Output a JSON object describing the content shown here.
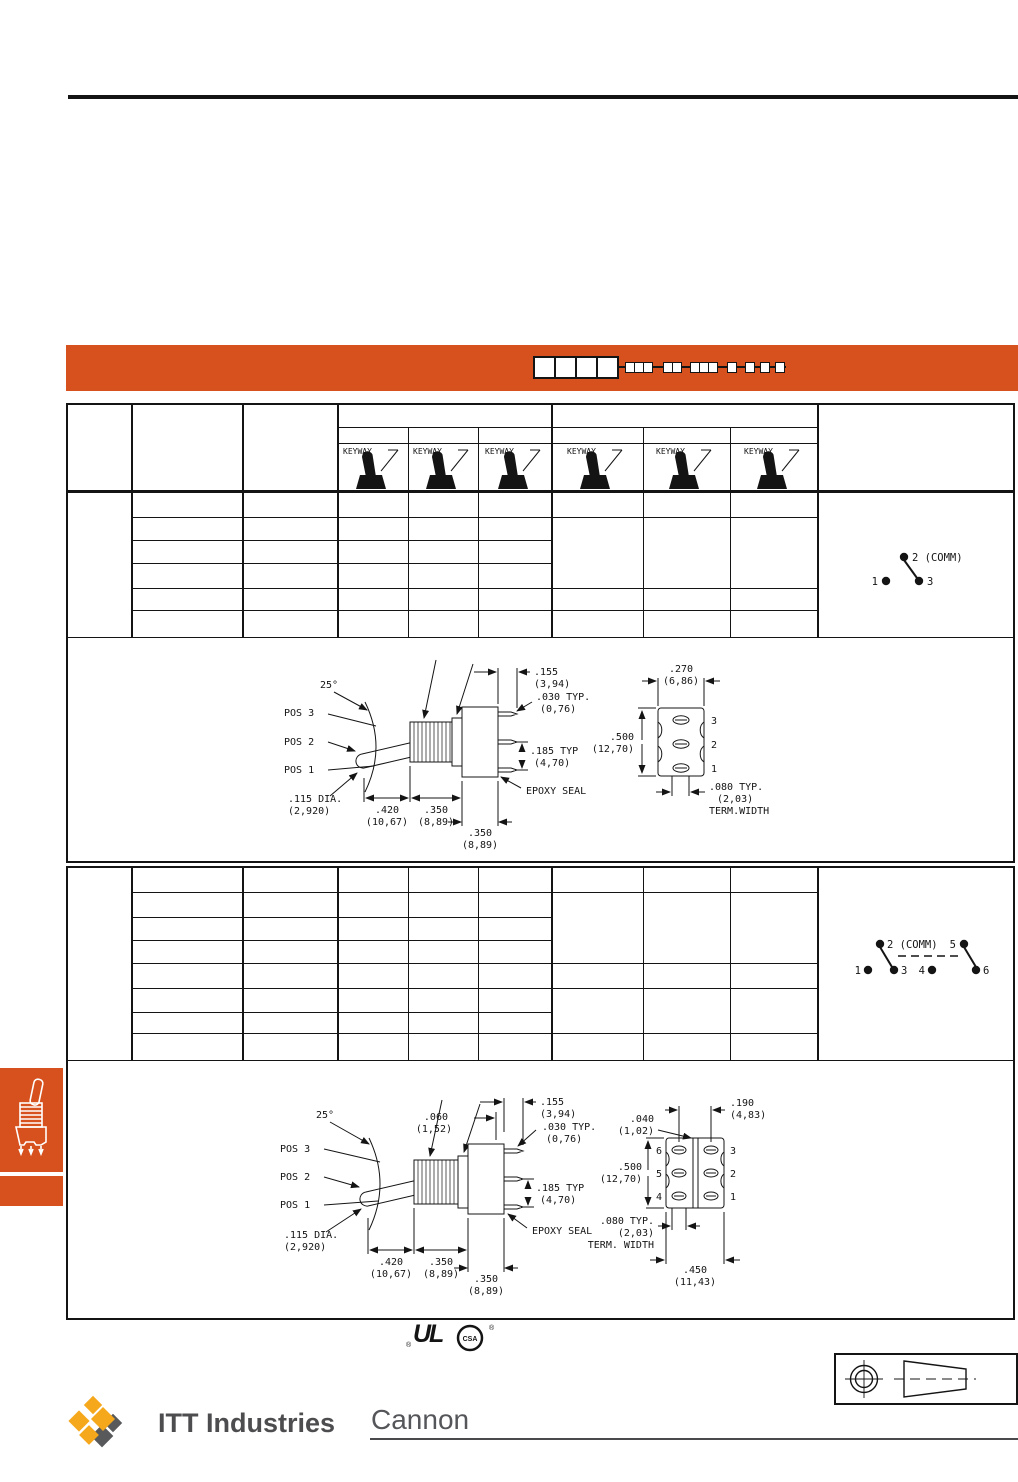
{
  "colors": {
    "accent_orange": "#d6511e",
    "line_black": "#141414",
    "footer_gray": "#4d4d4f",
    "logo_gold": "#f5a81c",
    "logo_shadow_gray": "#58595b"
  },
  "banner": {
    "part_number_large_boxes": 4,
    "part_number_small_groups": [
      3,
      2,
      3,
      1,
      1,
      1,
      1
    ]
  },
  "table1": {
    "keyway_label": "KEYWAY",
    "circuit": {
      "common": "2 (COMM)",
      "left": "1",
      "right": "3"
    }
  },
  "table2": {
    "circuit": {
      "common": "2 (COMM)",
      "pole2": "5",
      "p1_left": "1",
      "p1_right": "3",
      "p2_left": "4",
      "p2_right": "6"
    }
  },
  "drawing1": {
    "angle": "25°",
    "pos3": "POS 3",
    "pos2": "POS 2",
    "pos1": "POS 1",
    "dia": ".115 DIA.",
    "dia_mm": "(2,920)",
    "len420": ".420",
    "len420_mm": "(10,67)",
    "len350a": ".350",
    "len350a_mm": "(8,89)",
    "len350b": ".350",
    "len350b_mm": "(8,89)",
    "dim155": ".155",
    "dim155_mm": "(3,94)",
    "dim030": ".030 TYP.",
    "dim030_mm": "(0,76)",
    "dim185": ".185 TYP",
    "dim185_mm": "(4,70)",
    "epoxy": "EPOXY SEAL",
    "dim270": ".270",
    "dim270_mm": "(6,86)",
    "dim500": ".500",
    "dim500_mm": "(12,70)",
    "term3": "3",
    "term2": "2",
    "term1": "1",
    "dim080": ".080 TYP.",
    "dim080_mm": "(2,03)",
    "term_width": "TERM.WIDTH"
  },
  "drawing2": {
    "angle": "25°",
    "pos3": "POS 3",
    "pos2": "POS 2",
    "pos1": "POS 1",
    "dia": ".115 DIA.",
    "dia_mm": "(2,920)",
    "len420": ".420",
    "len420_mm": "(10,67)",
    "len350a": ".350",
    "len350a_mm": "(8,89)",
    "len350b": ".350",
    "len350b_mm": "(8,89)",
    "dim060": ".060",
    "dim060_mm": "(1,52)",
    "dim155": ".155",
    "dim155_mm": "(3,94)",
    "dim030": ".030 TYP.",
    "dim030_mm": "(0,76)",
    "dim185": ".185 TYP",
    "dim185_mm": "(4,70)",
    "epoxy": "EPOXY SEAL",
    "dim190": ".190",
    "dim190_mm": "(4,83)",
    "dim040": ".040",
    "dim040_mm": "(1,02)",
    "dim500": ".500",
    "dim500_mm": "(12,70)",
    "dim450": ".450",
    "dim450_mm": "(11,43)",
    "term6": "6",
    "term5": "5",
    "term4": "4",
    "term3": "3",
    "term2": "2",
    "term1": "1",
    "dim080": ".080 TYP.",
    "dim080_mm": "(2,03)",
    "term_width": "TERM. WIDTH"
  },
  "certifications": {
    "ul_text": "UL",
    "csa_text": "CSA",
    "reg": "®"
  },
  "footer": {
    "company": "ITT Industries",
    "division": "Cannon"
  }
}
